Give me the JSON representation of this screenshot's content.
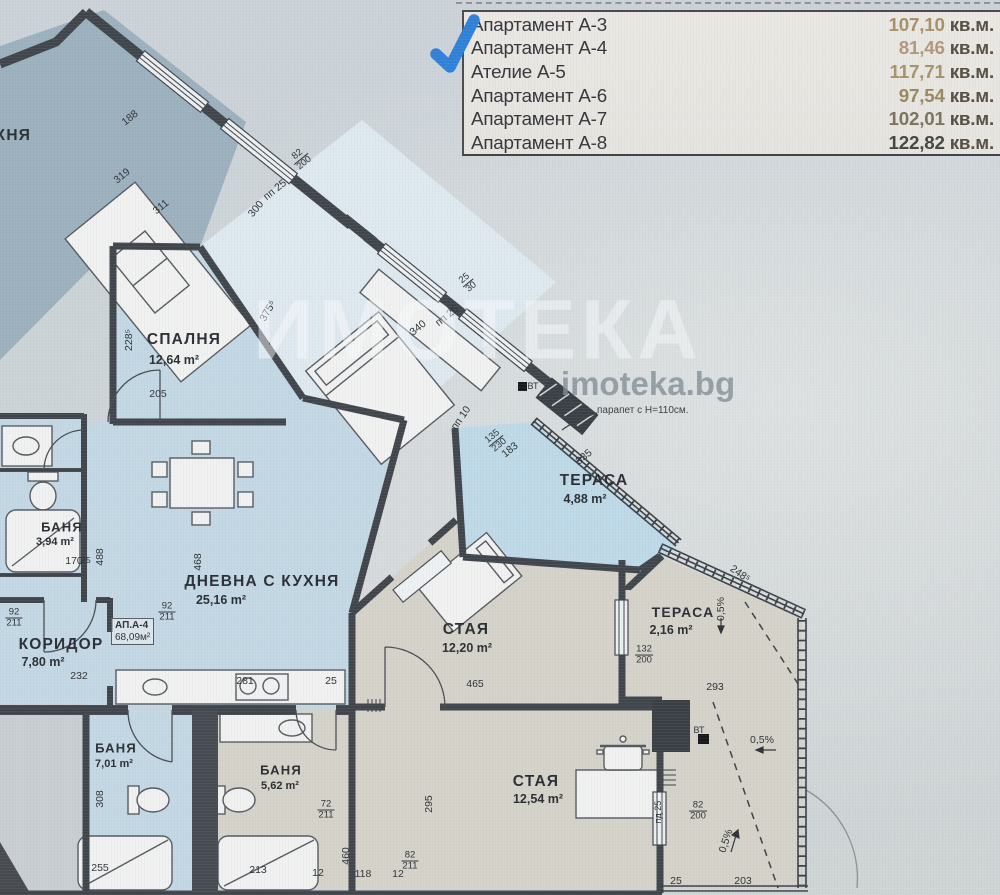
{
  "legend": {
    "rows": [
      {
        "name": "Апартамент А-3",
        "value": "107,10",
        "unit": " кв.м.",
        "value_color": "#a98f68"
      },
      {
        "name": "Апартамент А-4",
        "value": "81,46",
        "unit": " кв.м.",
        "value_color": "#b0997a"
      },
      {
        "name": "Ателие А-5",
        "value": "117,71",
        "unit": " кв.м.",
        "value_color": "#a8916b"
      },
      {
        "name": "Апартамент А-6",
        "value": "97,54",
        "unit": " кв.м.",
        "value_color": "#99875f"
      },
      {
        "name": "Апартамент А-7",
        "value": "102,01",
        "unit": " кв.м.",
        "value_color": "#7c715c"
      },
      {
        "name": "Апартамент А-8",
        "value": "122,82",
        "unit": " кв.м.",
        "value_color": "#47443e"
      }
    ]
  },
  "watermark": {
    "brand": "ИМОТЕКА",
    "site": "imoteka.bg"
  },
  "apartment_tag": {
    "line1": "АП.А-4",
    "line2": "68,09м²"
  },
  "notes": {
    "parapet": "парапет с Н=110см."
  },
  "colors": {
    "checkmark": "#2f80d8",
    "wall": "#40454c",
    "blue_room": "#c3d8e4",
    "beige_room": "#d5d2c9",
    "dark_room": "#9cb0be",
    "terrace_blue": "#bed9e7",
    "bedroom_mid": "#dee9ef",
    "hall": "#d6dadd",
    "window": "#edf0f1"
  },
  "labels": [
    {
      "t": "КУХНЯ",
      "x": 2,
      "y": 136,
      "cls": "room",
      "n": "room-label-kitchen"
    },
    {
      "t": "СПАЛНЯ",
      "x": 184,
      "y": 340,
      "cls": "room",
      "n": "room-label-bedroom"
    },
    {
      "t": "12,64 m²",
      "x": 174,
      "y": 360,
      "cls": "area",
      "n": "room-area-bedroom"
    },
    {
      "t": "ДНЕВНА С КУХНЯ",
      "x": 262,
      "y": 582,
      "cls": "room",
      "n": "room-label-living"
    },
    {
      "t": "25,16 m²",
      "x": 221,
      "y": 600,
      "cls": "area",
      "n": "room-area-living"
    },
    {
      "t": "БАНЯ",
      "x": 62,
      "y": 527,
      "cls": "room",
      "fs": 13,
      "n": "room-label-bath1"
    },
    {
      "t": "3,94 m²",
      "x": 55,
      "y": 542,
      "cls": "area",
      "fs": 11,
      "n": "room-area-bath1"
    },
    {
      "t": "КОРИДОР",
      "x": 61,
      "y": 645,
      "cls": "room",
      "n": "room-label-corridor"
    },
    {
      "t": "7,80 m²",
      "x": 43,
      "y": 662,
      "cls": "area",
      "n": "room-area-corridor"
    },
    {
      "t": "ТЕРАСА",
      "x": 594,
      "y": 481,
      "cls": "room",
      "n": "room-label-terrace1"
    },
    {
      "t": "4,88 m²",
      "x": 585,
      "y": 499,
      "cls": "area",
      "n": "room-area-terrace1"
    },
    {
      "t": "СТАЯ",
      "x": 466,
      "y": 630,
      "cls": "room",
      "n": "room-label-room1"
    },
    {
      "t": "12,20 m²",
      "x": 467,
      "y": 648,
      "cls": "area",
      "n": "room-area-room1"
    },
    {
      "t": "ТЕРАСА",
      "x": 683,
      "y": 612,
      "cls": "room",
      "fs": 14,
      "n": "room-label-terrace2"
    },
    {
      "t": "2,16 m²",
      "x": 671,
      "y": 630,
      "cls": "area",
      "n": "room-area-terrace2"
    },
    {
      "t": "БАНЯ",
      "x": 116,
      "y": 748,
      "cls": "room",
      "fs": 13,
      "n": "room-label-bath2"
    },
    {
      "t": "7,01 m²",
      "x": 114,
      "y": 764,
      "cls": "area",
      "fs": 11,
      "n": "room-area-bath2"
    },
    {
      "t": "БАНЯ",
      "x": 281,
      "y": 770,
      "cls": "room",
      "fs": 13,
      "n": "room-label-bath3"
    },
    {
      "t": "5,62 m²",
      "x": 280,
      "y": 786,
      "cls": "area",
      "fs": 11,
      "n": "room-area-bath3"
    },
    {
      "t": "СТАЯ",
      "x": 536,
      "y": 782,
      "cls": "room",
      "n": "room-label-room2"
    },
    {
      "t": "12,54 m²",
      "x": 538,
      "y": 799,
      "cls": "area",
      "n": "room-area-room2"
    },
    {
      "t": "188",
      "x": 130,
      "y": 118,
      "r": -39
    },
    {
      "t": "319",
      "x": 122,
      "y": 176,
      "r": -39
    },
    {
      "t": "311",
      "x": 161,
      "y": 207,
      "r": -39
    },
    {
      "t": "пп 25",
      "x": 275,
      "y": 190,
      "r": -39
    },
    {
      "t": "300",
      "x": 256,
      "y": 209,
      "r": -50
    },
    {
      "t": "82",
      "t2": "200",
      "x": 301,
      "y": 159,
      "r": -39,
      "cls": "frac"
    },
    {
      "t": "375⁵",
      "x": 268,
      "y": 311,
      "r": -60
    },
    {
      "t": "228⁵",
      "x": 129,
      "y": 340,
      "r": -90
    },
    {
      "t": "205",
      "x": 158,
      "y": 394
    },
    {
      "t": "340",
      "x": 418,
      "y": 328,
      "r": -39
    },
    {
      "t": "пп 25",
      "x": 447,
      "y": 316,
      "r": -39
    },
    {
      "t": "25",
      "t2": "30",
      "x": 468,
      "y": 283,
      "r": -39,
      "cls": "frac"
    },
    {
      "t": "пп 10",
      "x": 461,
      "y": 418,
      "r": -55
    },
    {
      "t": "135",
      "t2": "230",
      "x": 496,
      "y": 441,
      "r": -39,
      "cls": "frac"
    },
    {
      "t": "183",
      "x": 510,
      "y": 450,
      "r": -39
    },
    {
      "t": "335",
      "x": 584,
      "y": 457,
      "r": -39
    },
    {
      "t": "248⁵",
      "x": 740,
      "y": 574,
      "r": 35
    },
    {
      "t": "92",
      "t2": "211",
      "x": 14,
      "y": 618,
      "cls": "frac"
    },
    {
      "t": "92",
      "t2": "211",
      "x": 167,
      "y": 612,
      "cls": "frac"
    },
    {
      "t": "232",
      "x": 79,
      "y": 676
    },
    {
      "t": "170",
      "x": 74,
      "y": 561
    },
    {
      "t": "25",
      "x": 86,
      "y": 560,
      "fs": 8.5
    },
    {
      "t": "488",
      "x": 100,
      "y": 557,
      "r": -90
    },
    {
      "t": "468",
      "x": 198,
      "y": 562,
      "r": -90
    },
    {
      "t": "281",
      "x": 245,
      "y": 681
    },
    {
      "t": "25",
      "x": 331,
      "y": 681
    },
    {
      "t": "465",
      "x": 475,
      "y": 684
    },
    {
      "t": "293",
      "x": 715,
      "y": 687
    },
    {
      "t": "132",
      "t2": "200",
      "x": 644,
      "y": 655,
      "cls": "frac"
    },
    {
      "t": "0,5%",
      "x": 721,
      "y": 609,
      "r": -90,
      "n": "slope-label"
    },
    {
      "t": "0,5%",
      "x": 762,
      "y": 740,
      "n": "slope-label"
    },
    {
      "t": "0,5%",
      "x": 726,
      "y": 841,
      "r": -72,
      "n": "slope-label"
    },
    {
      "t": "ВТ",
      "x": 533,
      "y": 386,
      "fs": 9,
      "n": "vt-label"
    },
    {
      "t": "ВТ",
      "x": 699,
      "y": 730,
      "fs": 9,
      "n": "vt-label"
    },
    {
      "t": "308",
      "x": 100,
      "y": 799,
      "r": -90
    },
    {
      "t": "295",
      "x": 429,
      "y": 804,
      "r": -90
    },
    {
      "t": "460",
      "x": 346,
      "y": 856,
      "r": -90
    },
    {
      "t": "72",
      "t2": "211",
      "x": 326,
      "y": 810,
      "cls": "frac"
    },
    {
      "t": "82",
      "t2": "211",
      "x": 410,
      "y": 861,
      "cls": "frac"
    },
    {
      "t": "82",
      "t2": "200",
      "x": 698,
      "y": 811,
      "cls": "frac"
    },
    {
      "t": "пд 25",
      "x": 658,
      "y": 812,
      "r": -90,
      "fs": 9
    },
    {
      "t": "213",
      "x": 258,
      "y": 870
    },
    {
      "t": "12",
      "x": 318,
      "y": 873
    },
    {
      "t": "118",
      "x": 363,
      "y": 874
    },
    {
      "t": "12",
      "x": 398,
      "y": 874
    },
    {
      "t": "255",
      "x": 100,
      "y": 868
    },
    {
      "t": "203",
      "x": 743,
      "y": 881
    },
    {
      "t": "25",
      "x": 676,
      "y": 881
    }
  ]
}
